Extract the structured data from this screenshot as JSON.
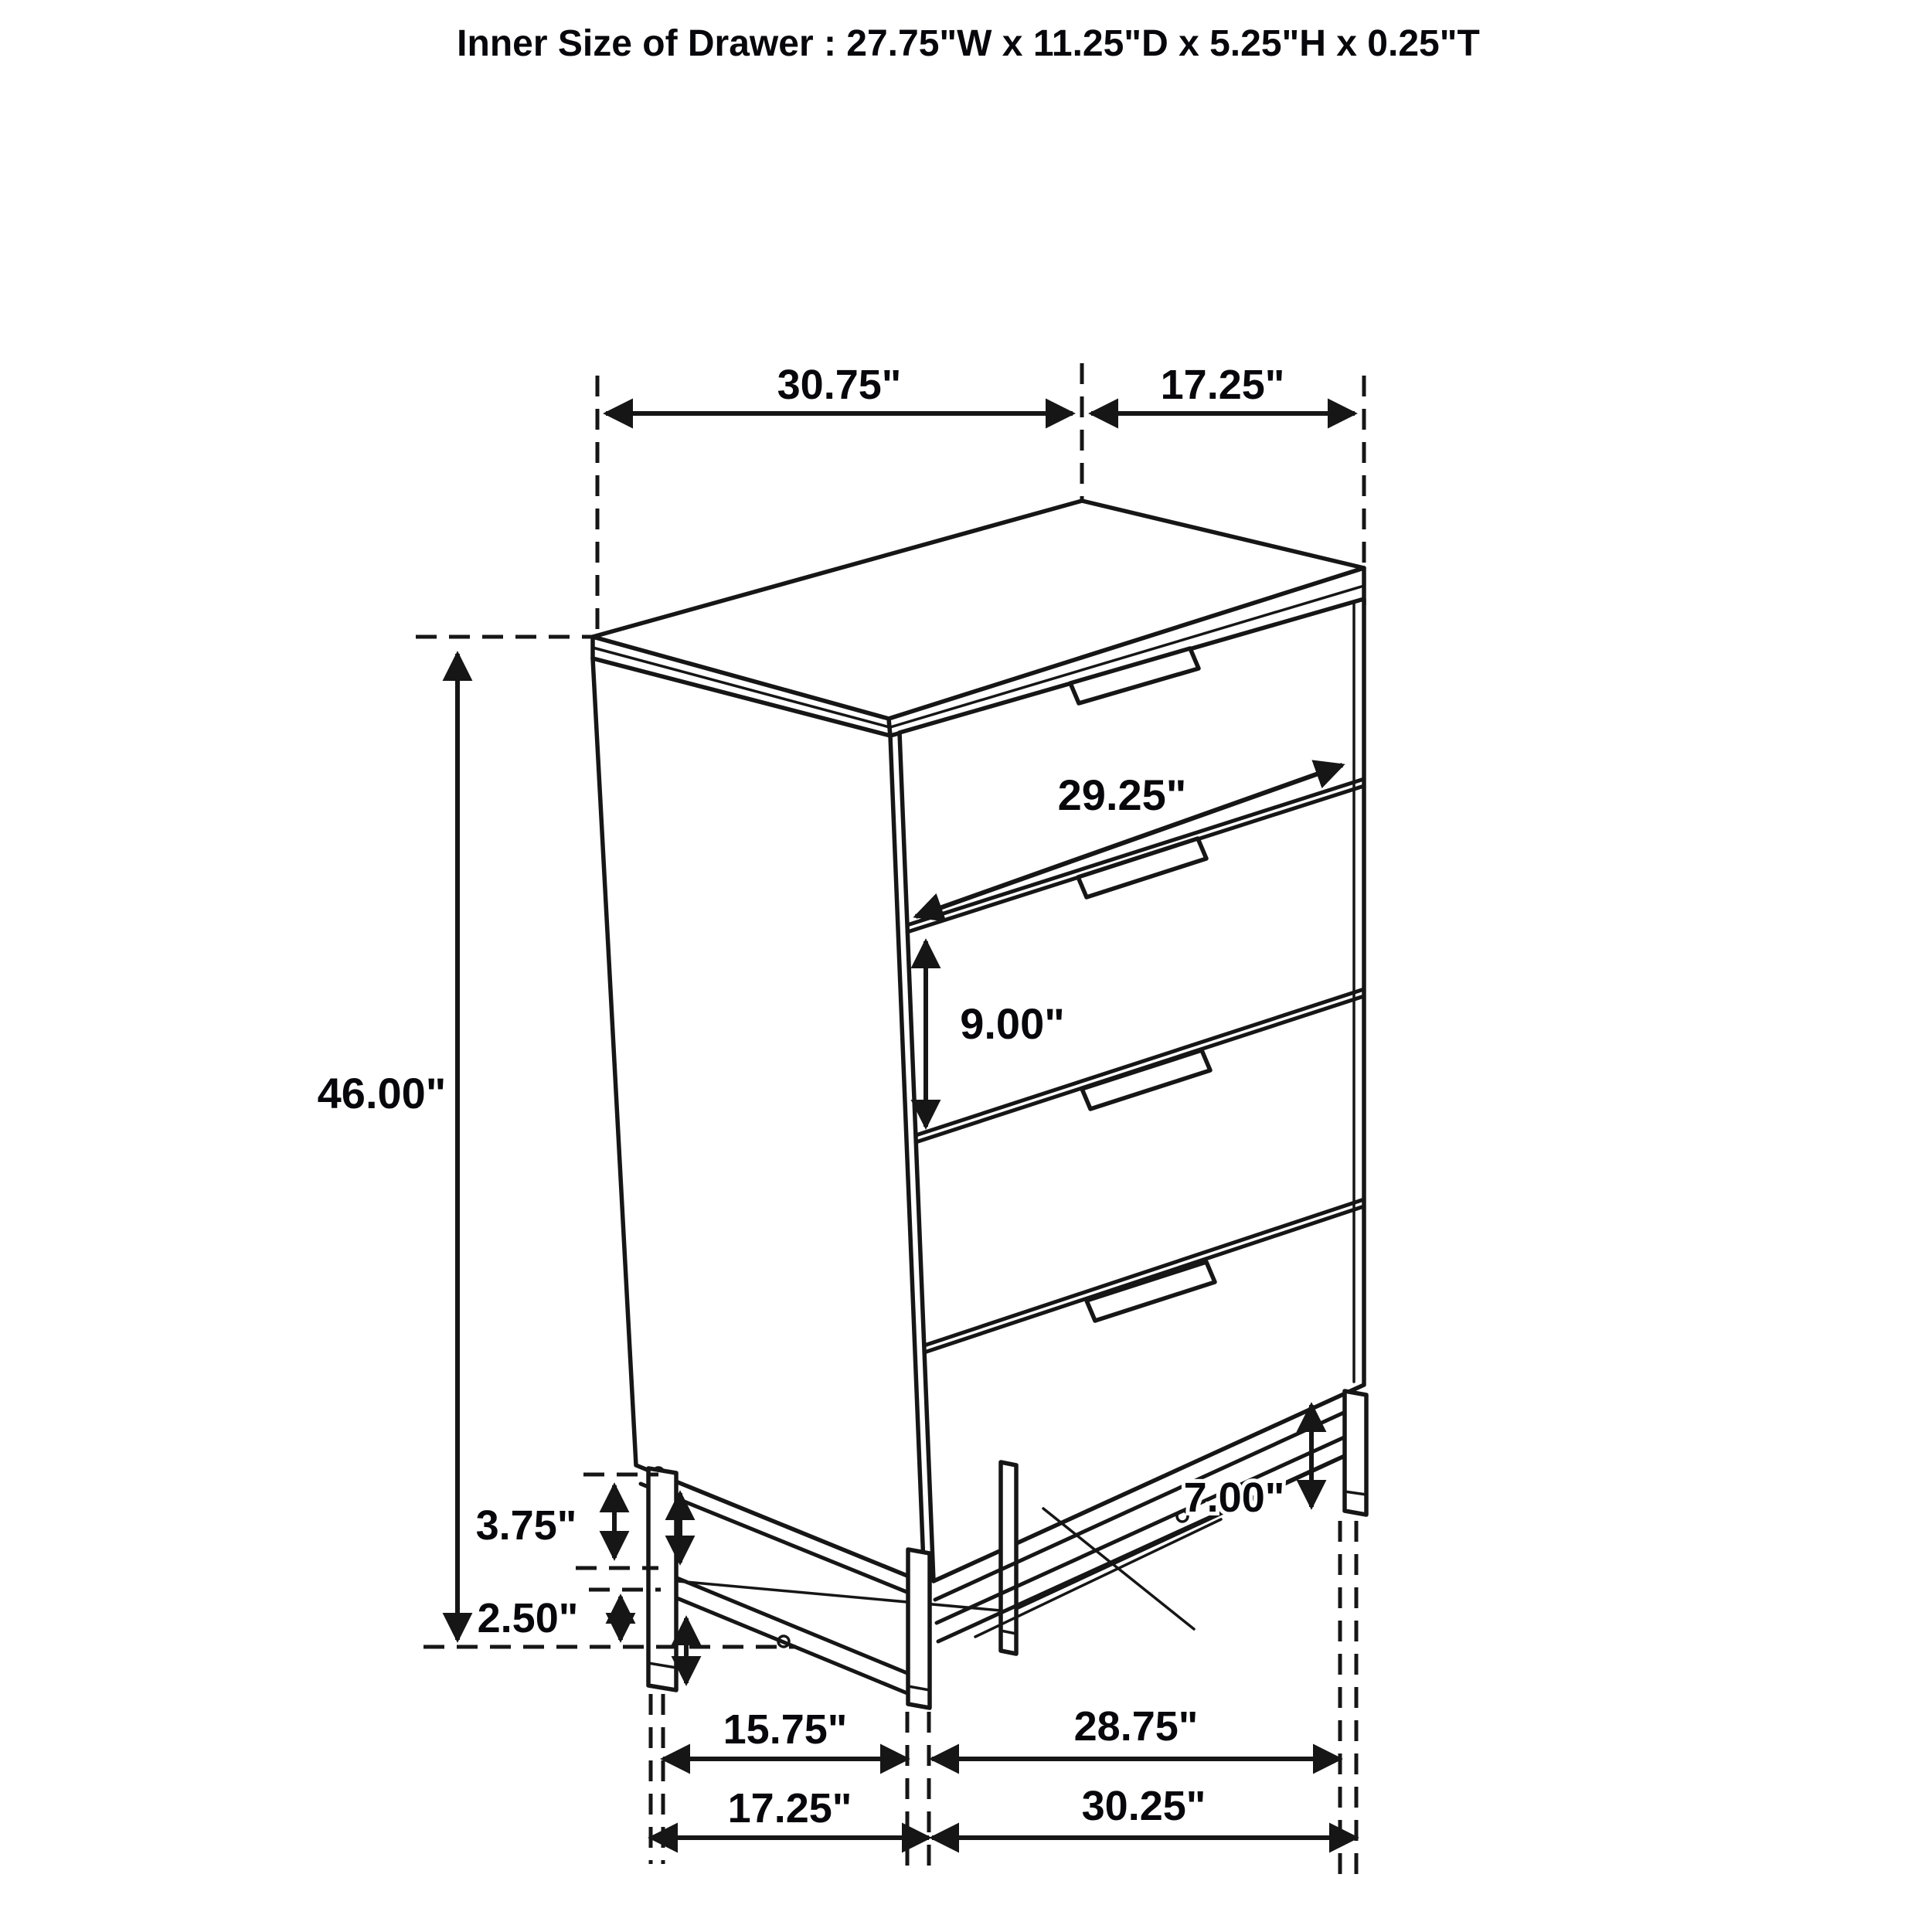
{
  "title": "Inner Size of Drawer : 27.75\"W x 11.25\"D x 5.25\"H x 0.25\"T",
  "dims": {
    "top_width": "30.75\"",
    "top_depth": "17.25\"",
    "drawer_face_width": "29.25\"",
    "drawer_face_height": "9.00\"",
    "overall_height": "46.00\"",
    "base_frame_height": "3.75\"",
    "base_lower_height": "2.50\"",
    "leg_height": "7.00\"",
    "feet_span_side_inner": "15.75\"",
    "feet_span_front_inner": "28.75\"",
    "feet_span_side_outer": "17.25\"",
    "feet_span_front_outer": "30.25\""
  }
}
